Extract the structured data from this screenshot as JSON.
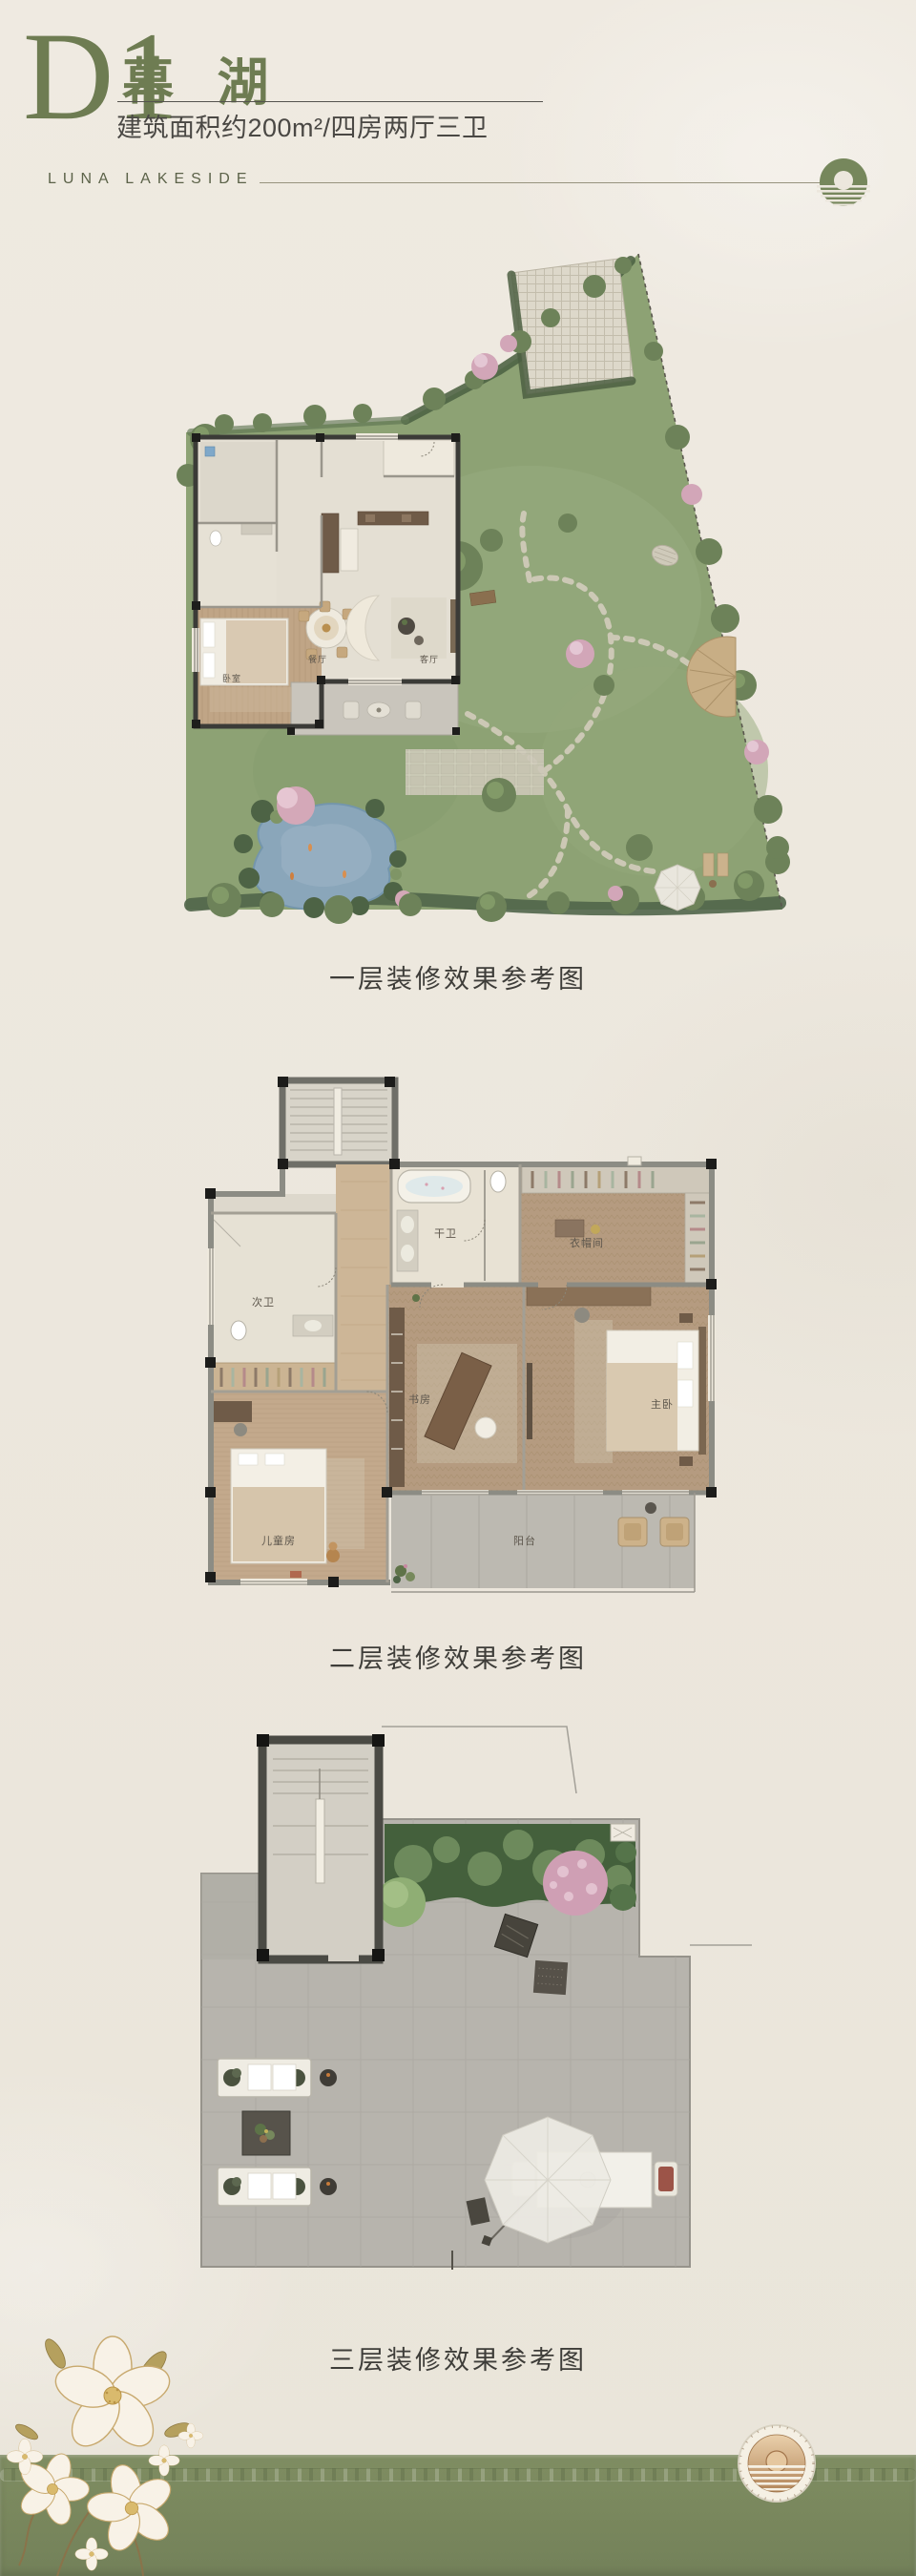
{
  "header": {
    "unit_code": "D1",
    "unit_name": "幕 湖",
    "spec_line": "建筑面积约200m²/四房两厅三卫",
    "brand_en": "LUNA LAKESIDE"
  },
  "colors": {
    "accent_green": "#6e7c52",
    "band_green": "#7d8b61",
    "garden_green": "#8da274",
    "pond_blue": "#8aa6ba",
    "bronze_seal": "#c49a6f",
    "text_dark": "#3e3d39"
  },
  "floor1": {
    "caption": "一层装修效果参考图",
    "labels": {
      "dining": "餐厅",
      "living": "客厅",
      "bedroom": "卧室"
    }
  },
  "floor2": {
    "caption": "二层装修效果参考图",
    "labels": {
      "guest_bath": "干卫",
      "closet": "衣帽间",
      "second_bath": "次卫",
      "study": "书房",
      "master": "主卧",
      "kids_room": "儿童房",
      "balcony": "阳台"
    }
  },
  "floor3": {
    "caption": "三层装修效果参考图"
  },
  "icons": {
    "top_logo": "sun-over-lake-icon",
    "seal": "bronze-sun-seal-icon",
    "flowers": "white-blossom-decoration"
  }
}
